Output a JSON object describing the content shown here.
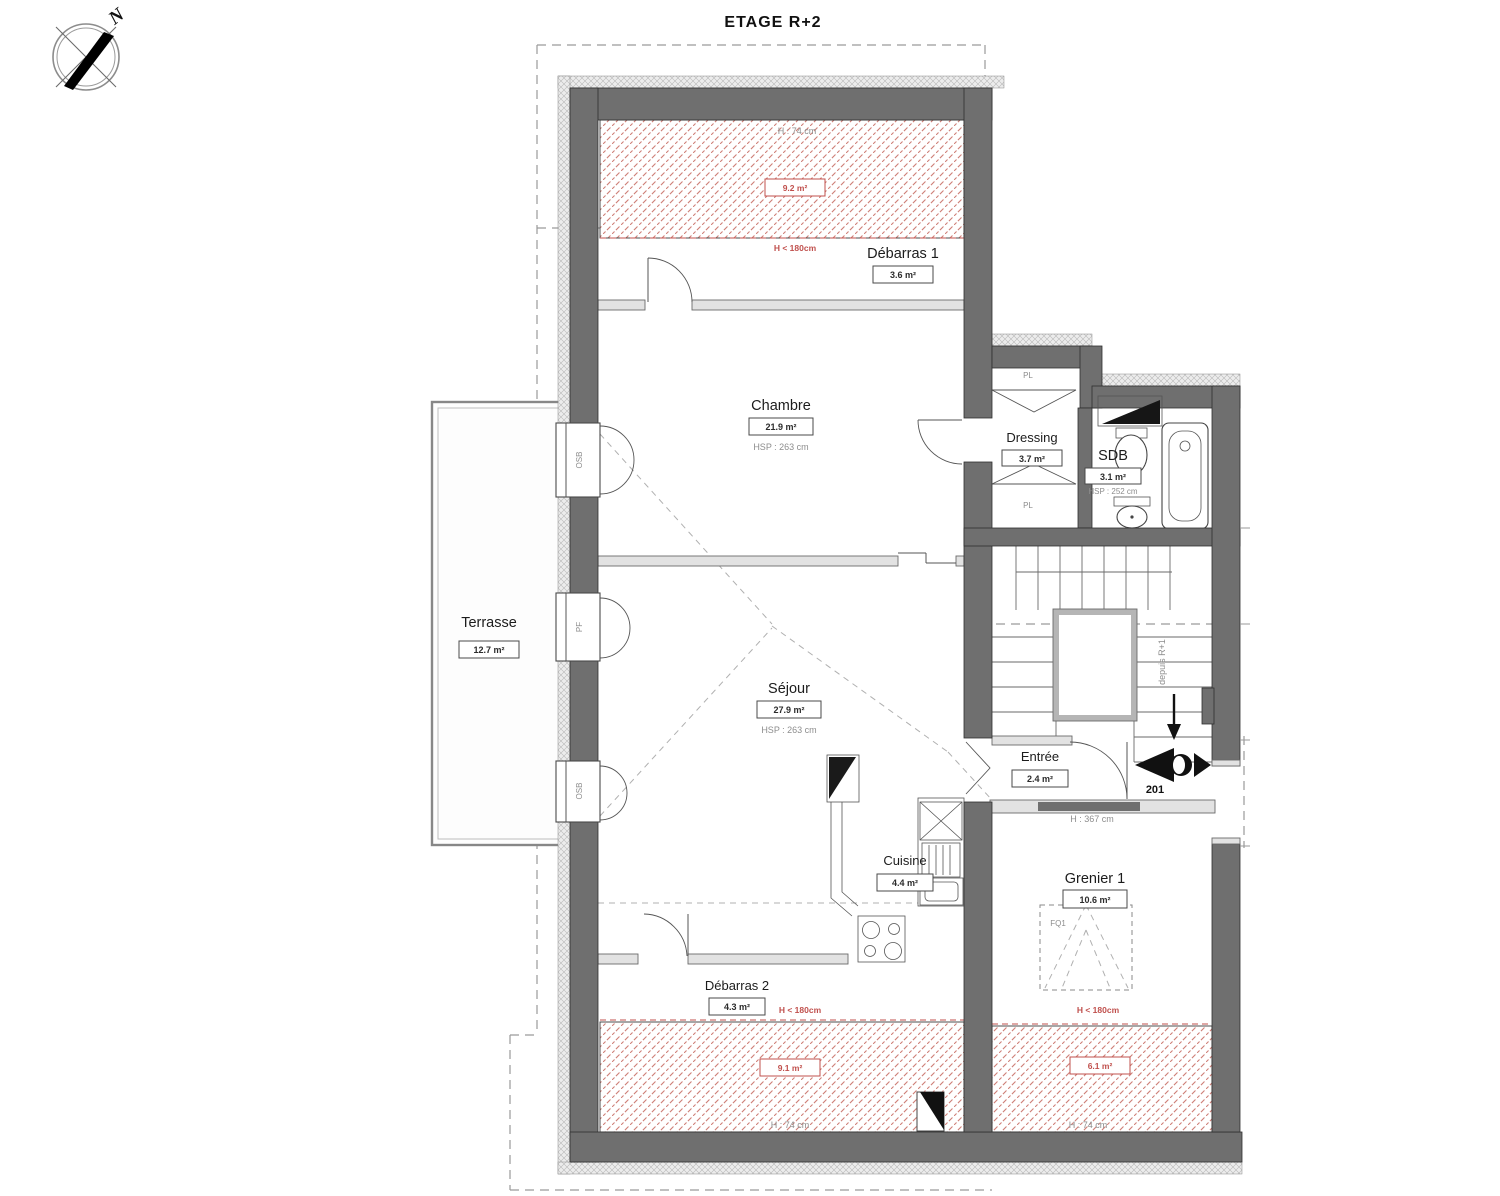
{
  "title": "ETAGE R+2",
  "compass": {
    "north_label": "N"
  },
  "rooms": {
    "debarras1": {
      "name": "Débarras 1",
      "area": "3.6 m²"
    },
    "chambre": {
      "name": "Chambre",
      "area": "21.9 m²",
      "ceiling": "HSP : 263 cm"
    },
    "dressing": {
      "name": "Dressing",
      "area": "3.7 m²"
    },
    "sdb": {
      "name": "SDB",
      "area": "3.1 m²",
      "ceiling": "HSP : 252 cm"
    },
    "terrasse": {
      "name": "Terrasse",
      "area": "12.7 m²"
    },
    "sejour": {
      "name": "Séjour",
      "area": "27.9 m²",
      "ceiling": "HSP : 263 cm"
    },
    "entree": {
      "name": "Entrée",
      "area": "2.4 m²"
    },
    "cuisine": {
      "name": "Cuisine",
      "area": "4.4 m²"
    },
    "debarras2": {
      "name": "Débarras 2",
      "area": "4.3 m²"
    },
    "grenier1": {
      "name": "Grenier 1",
      "area": "10.6 m²"
    }
  },
  "low_height_zones": {
    "top": {
      "area": "9.2 m²",
      "height": "H : 74 cm",
      "limit": "H < 180cm"
    },
    "bottom_left": {
      "area": "9.1 m²",
      "height": "H : 74 cm",
      "limit": "H < 180cm"
    },
    "bottom_right": {
      "area": "6.1 m²",
      "height": "H : 74 cm",
      "limit": "H < 180cm"
    }
  },
  "annotations": {
    "door_number": "201",
    "stair_from": "depuis R+1",
    "beam_height": "H : 367 cm",
    "closet_top": "PL",
    "closet_bottom": "PL",
    "window_top": "OSB",
    "window_middle": "PF",
    "window_bottom": "OSB",
    "roof_window": "FQ1"
  },
  "colors": {
    "wall": "#6f6f6f",
    "hatch_red": "#cf8078",
    "annotation_red": "#c0504d"
  }
}
